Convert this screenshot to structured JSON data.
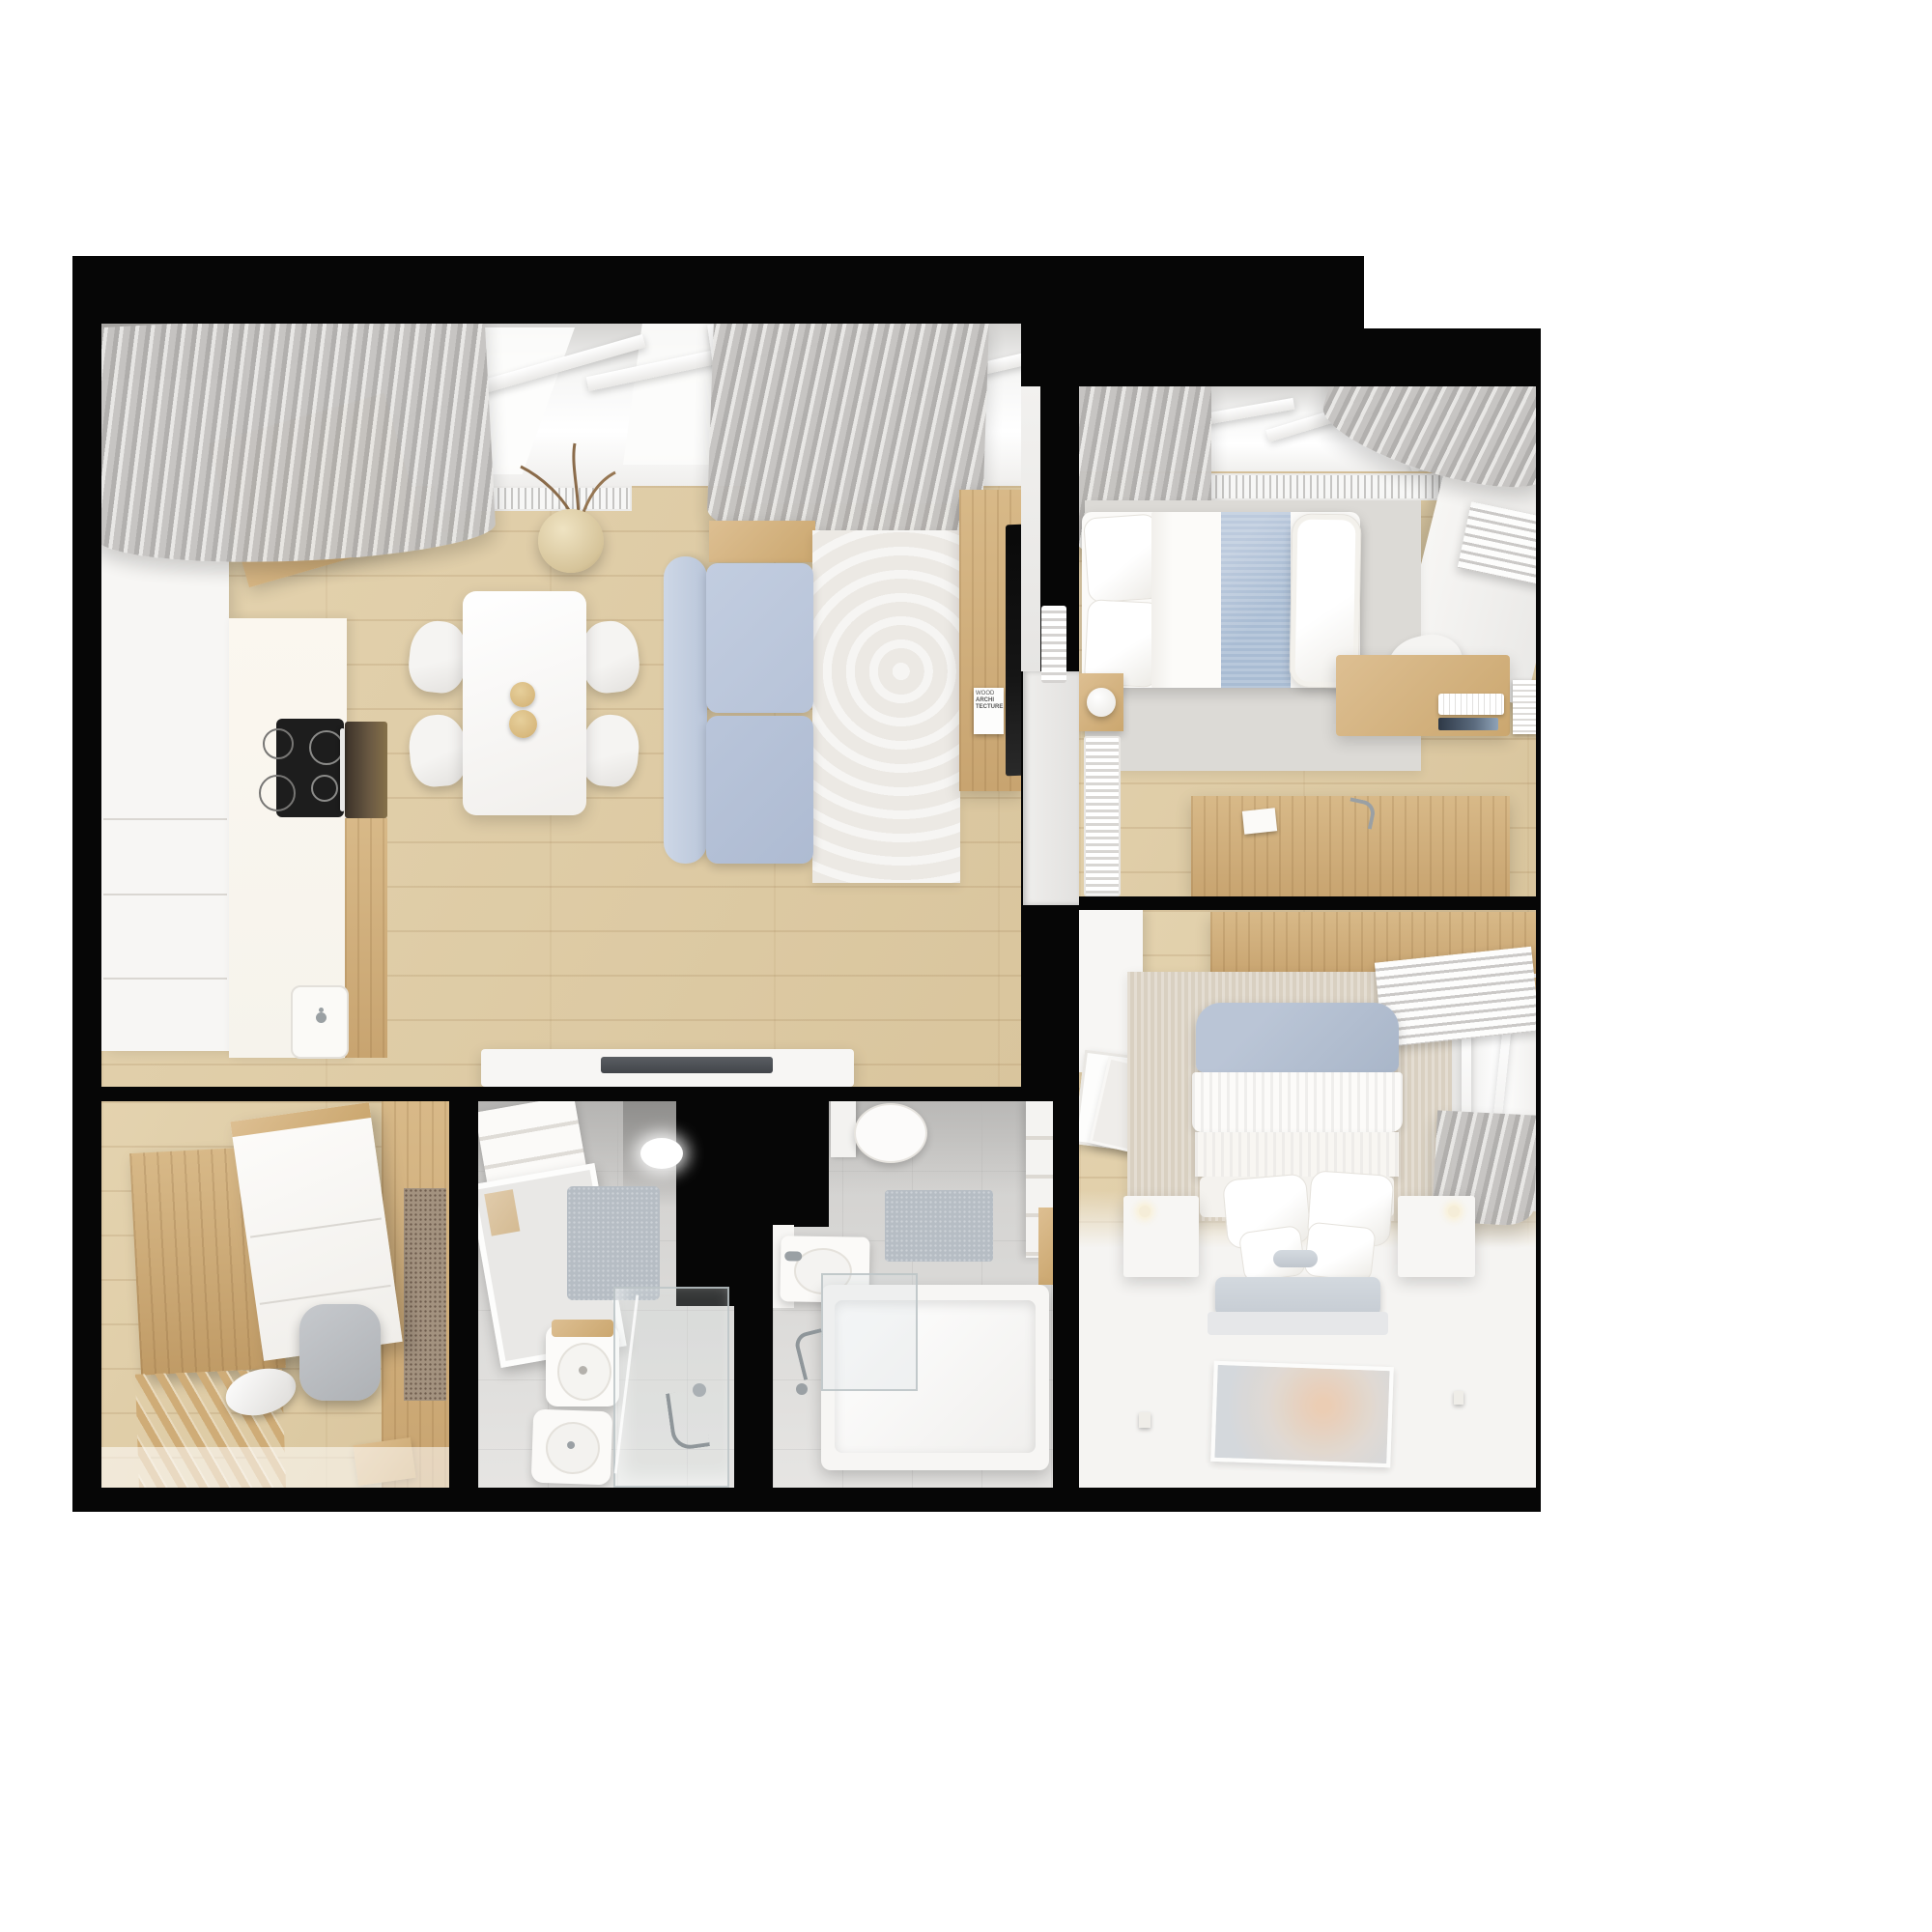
{
  "scene": {
    "type": "photorealistic 3D rendered apartment floor plan, top-down bird's-eye view",
    "background": "white page, thick black wall outline",
    "rooms": [
      "living-room-with-kitchen",
      "small-bedroom",
      "master-bedroom",
      "shower-bathroom",
      "bathtub-bathroom",
      "entrance-hall"
    ]
  },
  "poster": {
    "line1": "WOOD",
    "line2": "ARCHI",
    "line3": "TECTURE"
  },
  "colors": {
    "page_bg": "#ffffff",
    "frame": "#060606",
    "wood_floor": "#d9c59d",
    "wood_furniture": "#d5b686",
    "white_furniture": "#f7f6f4",
    "sofa_blue": "#b7c3d8",
    "blanket_blue": "#a9bcd3",
    "headboard_blue": "#a9b6c9",
    "curtain_gray": "#c6c4c2",
    "rug_cream": "#ece9e4",
    "rug_gray": "#dcdad6",
    "rug_beige": "#d9d0c1",
    "mat_blue_gray": "#b6bdc4",
    "tile_gray": "#d8d7d5",
    "tv_black": "#151515",
    "cooktop_black": "#1d1d1d",
    "bowl_tan": "#d8b97e"
  }
}
